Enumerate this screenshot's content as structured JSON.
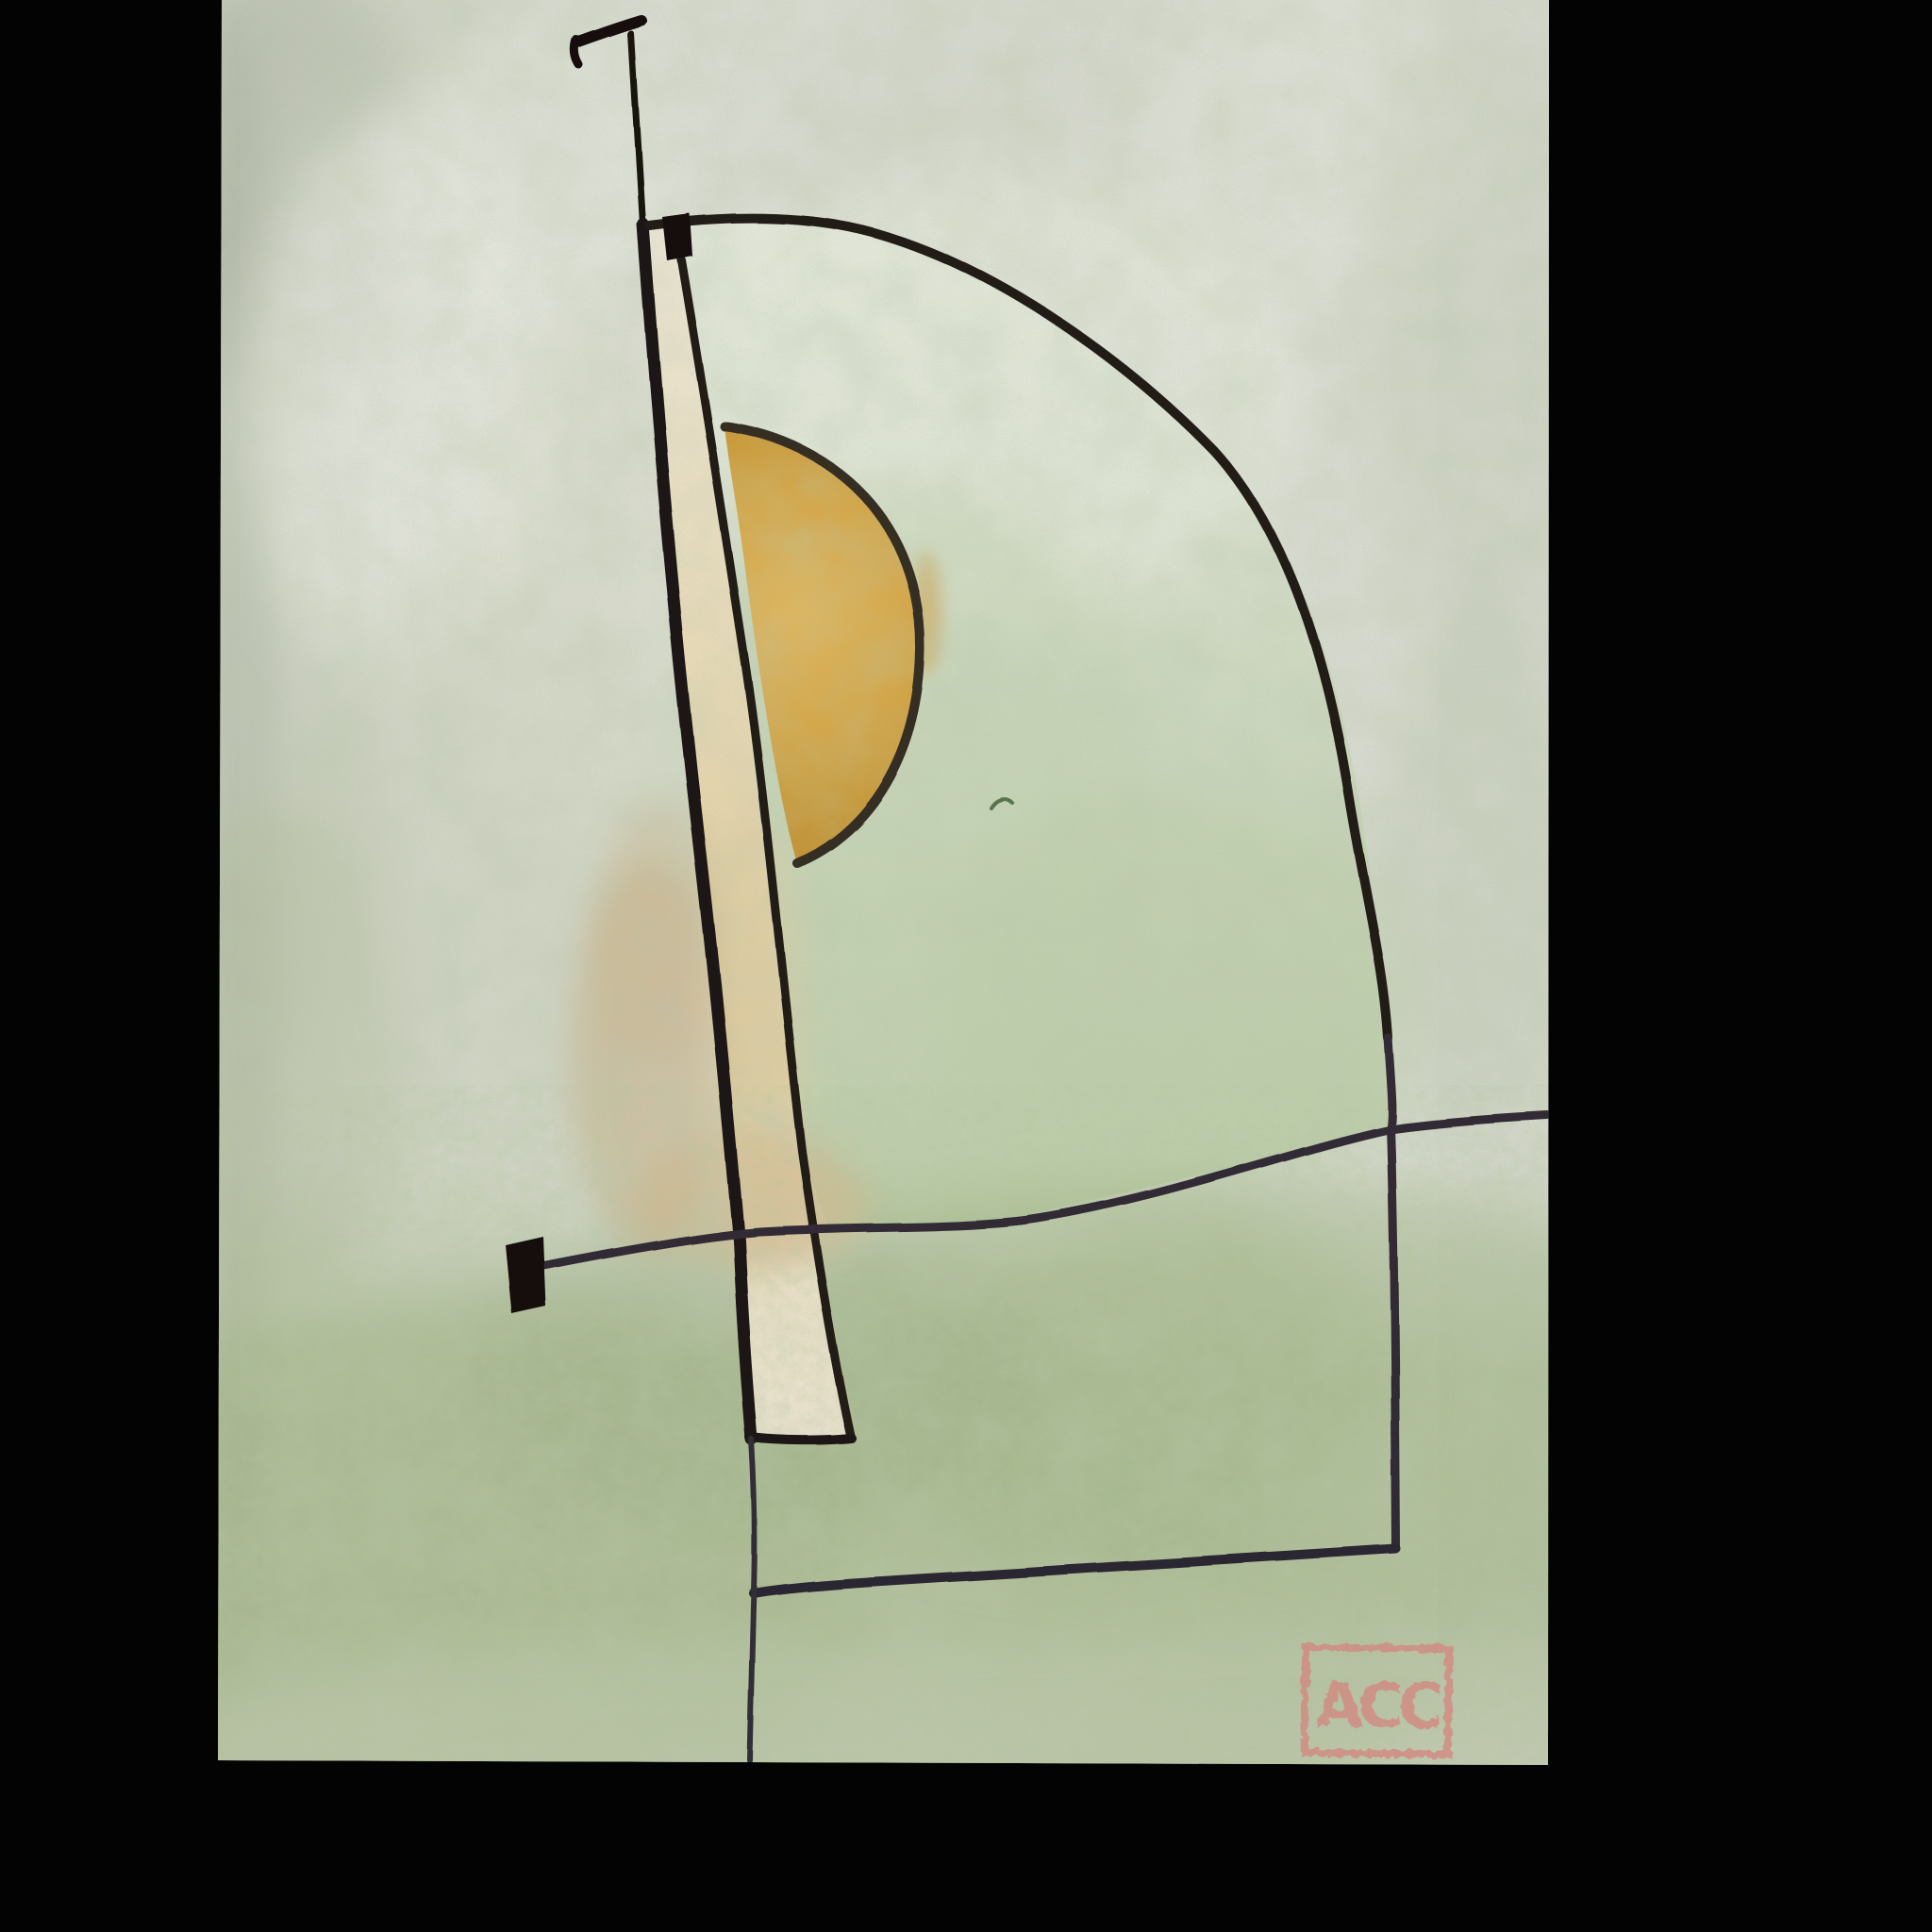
{
  "artwork": {
    "kind": "photograph of abstract watercolour-and-ink painting on textured paper",
    "backdrop_color": "#030303",
    "paper": {
      "base_color": "#DADCD2",
      "mottle_gray_green": "#ADB89C",
      "wash_white": "#EAECE3",
      "bottom_wash_green": "#9FB184",
      "arch_interior_green": "#C7D4B6"
    },
    "elements": {
      "ink_line_color": "#211C17",
      "pencil_line_color": "#332D38",
      "mast_and_tbar_color": "#14100D",
      "flag_color": "#120F0C",
      "strip_top_color": "#F0E8D8",
      "strip_mid_color": "#E4D1A5",
      "strip_stain_color": "#C9AC7E",
      "sun_fill": "#D2A23E",
      "sun_outline": "#362D22",
      "squiggle_color": "#57754E"
    },
    "stamp": {
      "initials": "ACC",
      "color": "#D28A82"
    }
  }
}
